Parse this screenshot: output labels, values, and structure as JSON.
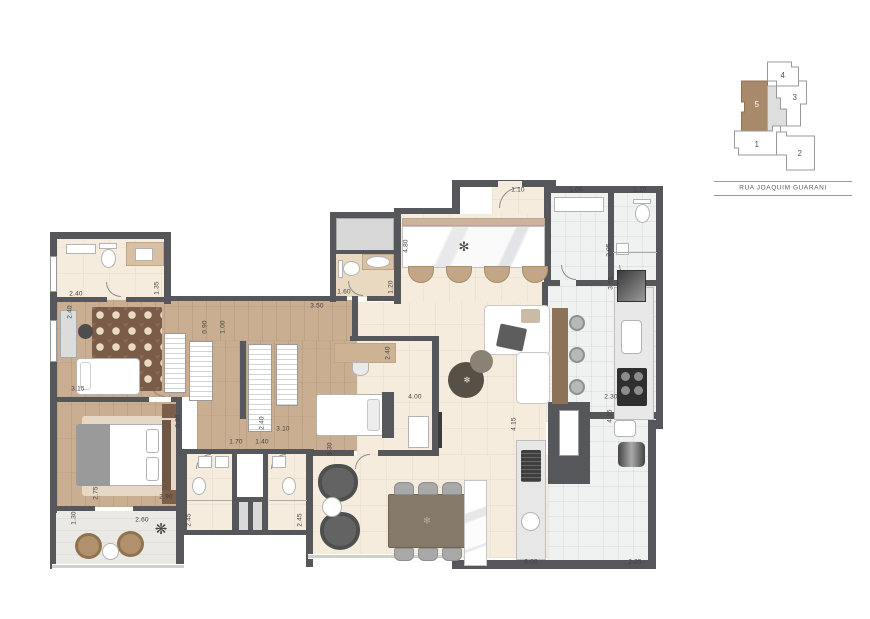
{
  "plan": {
    "dimensions": [
      {
        "t": "2.40"
      },
      {
        "t": "1.35"
      },
      {
        "t": "2.40"
      },
      {
        "t": "3.15"
      },
      {
        "t": "0.90"
      },
      {
        "t": "1.00"
      },
      {
        "t": "1.60"
      },
      {
        "t": "1.20"
      },
      {
        "t": "3.50"
      },
      {
        "t": "4.80"
      },
      {
        "t": "1.10"
      },
      {
        "t": "1.00"
      },
      {
        "t": "1.10"
      },
      {
        "t": "2.05"
      },
      {
        "t": "3.55"
      },
      {
        "t": "2.30"
      },
      {
        "t": "4.00"
      },
      {
        "t": "2.40"
      },
      {
        "t": "0.85"
      },
      {
        "t": "2.40"
      },
      {
        "t": "3.10"
      },
      {
        "t": "1.70"
      },
      {
        "t": "1.40"
      },
      {
        "t": "3.30"
      },
      {
        "t": "2.75"
      },
      {
        "t": "2.90"
      },
      {
        "t": "1.30"
      },
      {
        "t": "2.60"
      },
      {
        "t": "2.45"
      },
      {
        "t": "2.45"
      },
      {
        "t": "4.15"
      },
      {
        "t": "4.15"
      },
      {
        "t": "6.00"
      },
      {
        "t": "2.25"
      }
    ],
    "colors": {
      "wall": "#56575b",
      "wood_floor": "#c9ae92",
      "tile_beige": "#f5ecdd",
      "tile_gray": "#f0f1f1",
      "rug_brown": "#7a5c49"
    }
  },
  "keyplan": {
    "units": [
      "1",
      "2",
      "3",
      "4",
      "5"
    ],
    "highlighted_unit": "5",
    "highlight_color": "#a8896a",
    "street": "RUA JOAQUIM GUARANI"
  }
}
